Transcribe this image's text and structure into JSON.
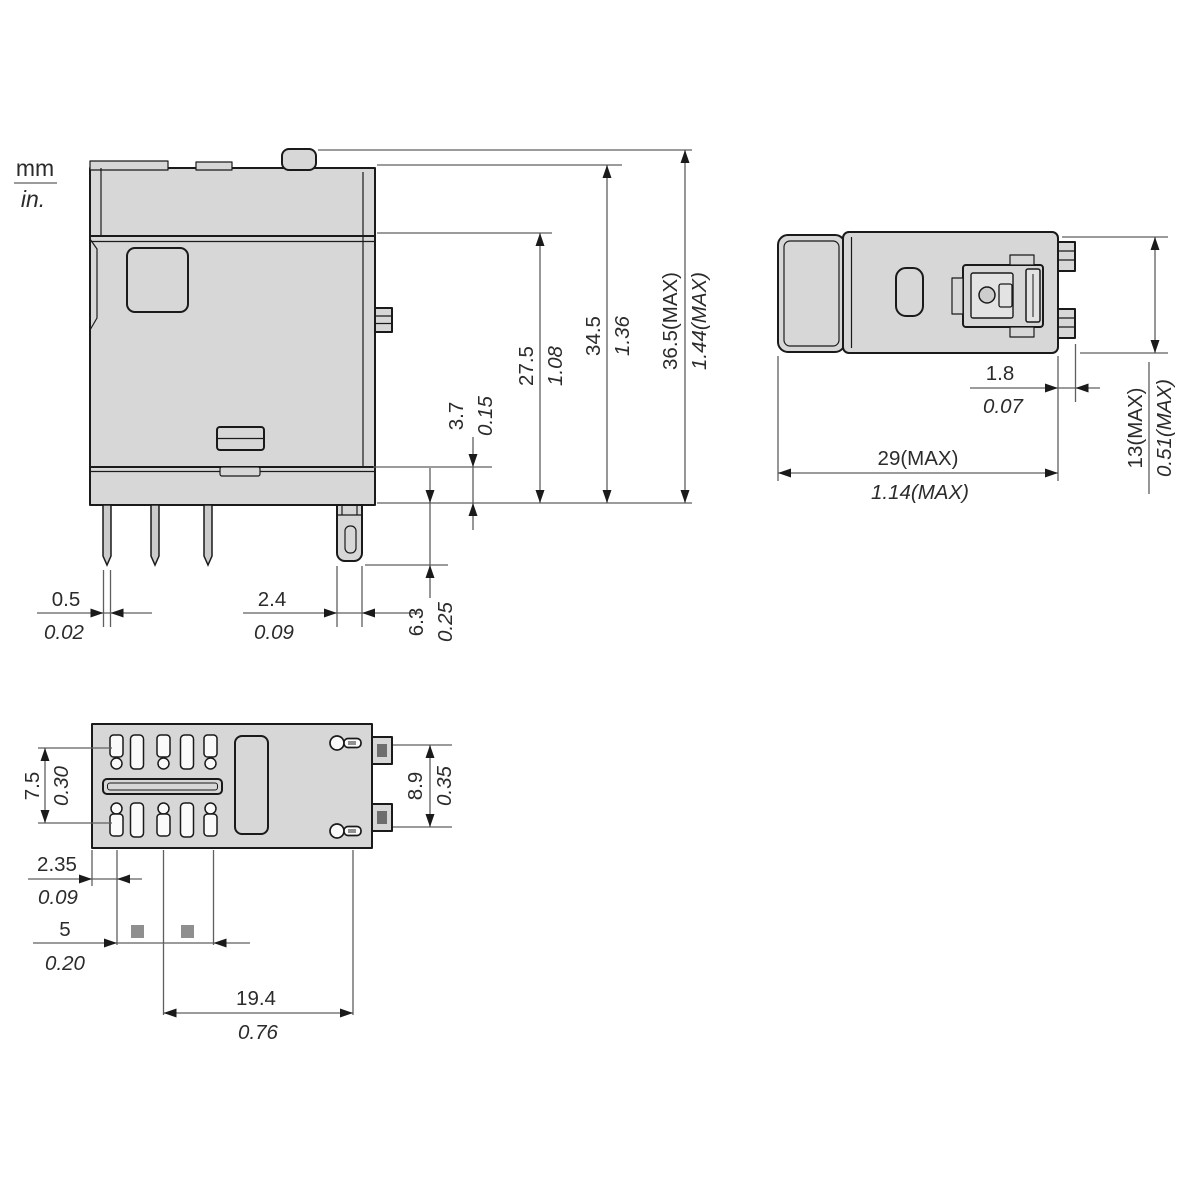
{
  "units": {
    "metric": "mm",
    "imperial": "in."
  },
  "front_view": {
    "overall_height": {
      "mm": "36.5(MAX)",
      "inch": "1.44(MAX)"
    },
    "body_height": {
      "mm": "34.5",
      "inch": "1.36"
    },
    "cover_height": {
      "mm": "27.5",
      "inch": "1.08"
    },
    "base_step_height": {
      "mm": "3.7",
      "inch": "0.15"
    },
    "terminal_length": {
      "mm": "6.3",
      "inch": "0.25"
    },
    "pin_thickness": {
      "mm": "0.5",
      "inch": "0.02"
    },
    "tab_terminal_width": {
      "mm": "2.4",
      "inch": "0.09"
    }
  },
  "side_view": {
    "overall_width": {
      "mm": "29(MAX)",
      "inch": "1.14(MAX)"
    },
    "overall_depth": {
      "mm": "13(MAX)",
      "inch": "0.51(MAX)"
    },
    "tab_terminal_thickness": {
      "mm": "1.8",
      "inch": "0.07"
    }
  },
  "bottom_view": {
    "pin_row_spacing": {
      "mm": "7.5",
      "inch": "0.30"
    },
    "tab_row_spacing": {
      "mm": "8.9",
      "inch": "0.35"
    },
    "edge_to_pin": {
      "mm": "2.35",
      "inch": "0.09"
    },
    "pin_pitch": {
      "mm": "5",
      "inch": "0.20"
    },
    "pin_span": {
      "mm": "19.4",
      "inch": "0.76"
    }
  },
  "colors": {
    "background": "#ffffff",
    "body_fill": "#d7d7d7",
    "outline": "#1a1a1a",
    "dimension_line": "#5f5f5f",
    "label_text": "#2b2b2b"
  }
}
